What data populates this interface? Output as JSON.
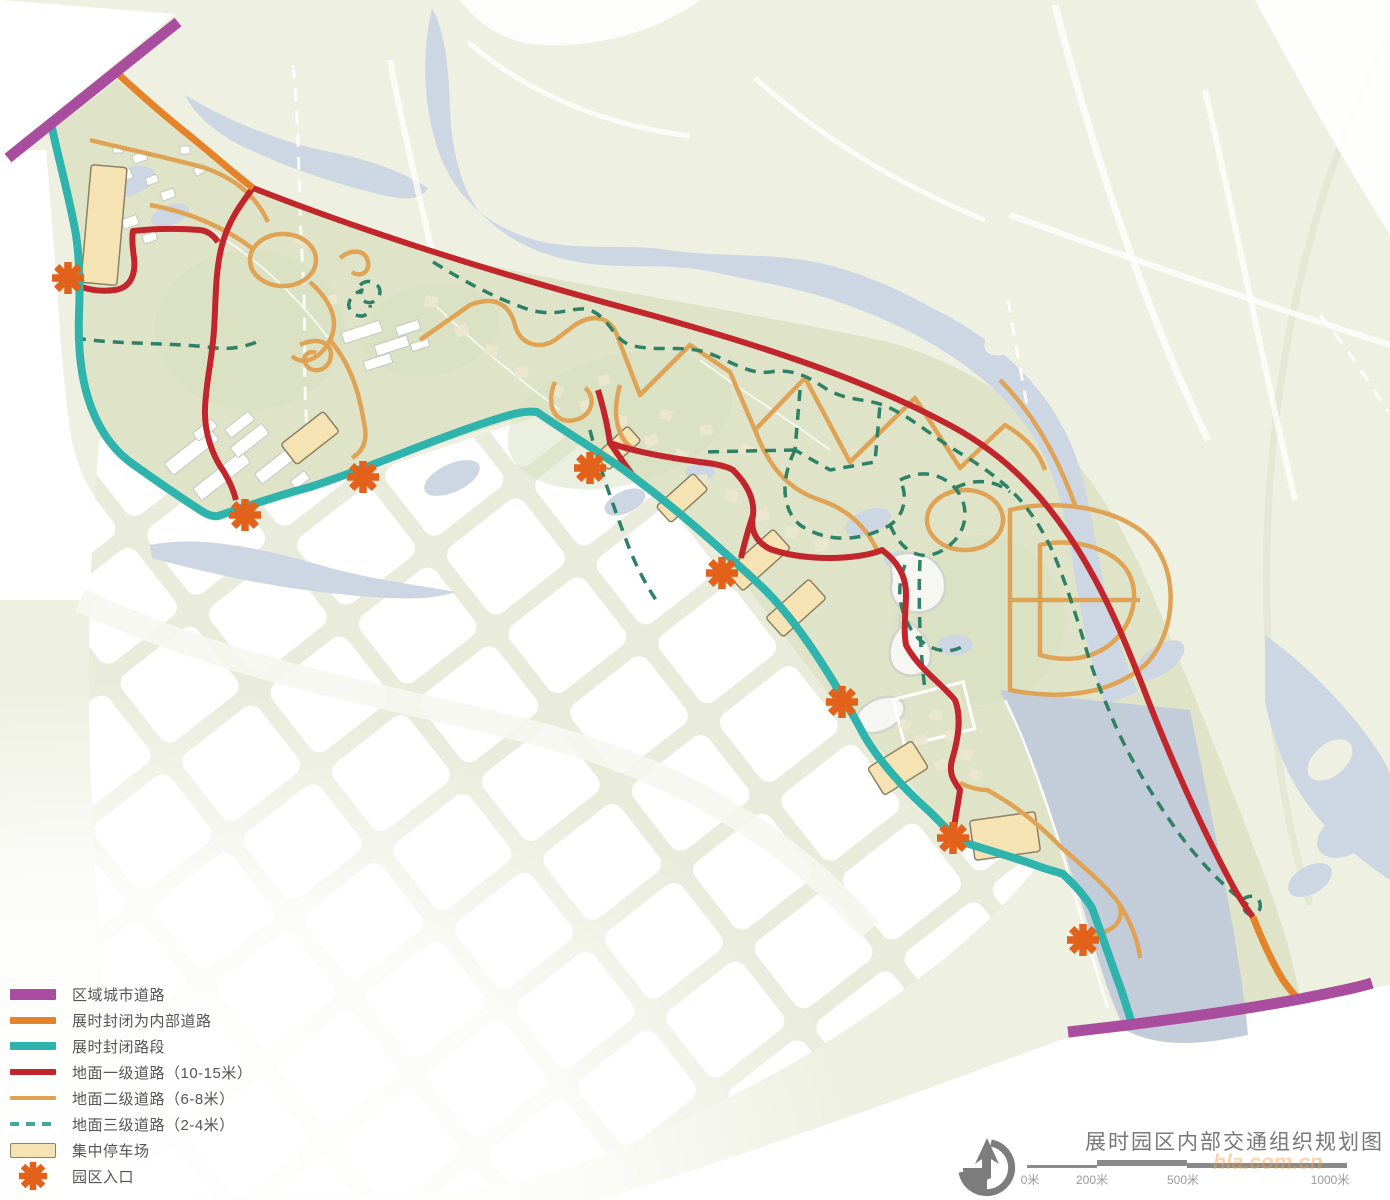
{
  "colors": {
    "regional_city_road": "#a94d9e",
    "closed_internal_road": "#e5832a",
    "closed_section": "#2fb3ad",
    "primary_road": "#c0262b",
    "secondary_road": "#dfa355",
    "tertiary_road": "#44a59b",
    "tertiary_road_map": "#2e8066",
    "parking_fill": "#f5e3b3",
    "parking_stroke": "#8d8163",
    "entrance": "#e2611b",
    "park_green": "#dfe4c8",
    "outer_green": "#eef0e1",
    "water": "#cdd6e3",
    "lake": "#c3cdda",
    "blocks_bg": "#e9ecdb",
    "text": "#555555",
    "title": "#787878",
    "scale": "#8a8a8a",
    "watermark": "#f2a24c"
  },
  "title": "展时园区内部交通组织规划图",
  "watermark": "hla.com.cn",
  "legend": {
    "items": [
      {
        "label": "区域城市道路"
      },
      {
        "label": "展时封闭为内部道路"
      },
      {
        "label": "展时封闭路段"
      },
      {
        "label": "地面一级道路（10-15米）"
      },
      {
        "label": "地面二级道路（6-8米）"
      },
      {
        "label": "地面三级道路（2-4米）"
      },
      {
        "label": "集中停车场"
      },
      {
        "label": "园区入口"
      }
    ]
  },
  "scale_bar": {
    "labels": [
      "0米",
      "200米",
      "500米",
      "1000米"
    ]
  }
}
